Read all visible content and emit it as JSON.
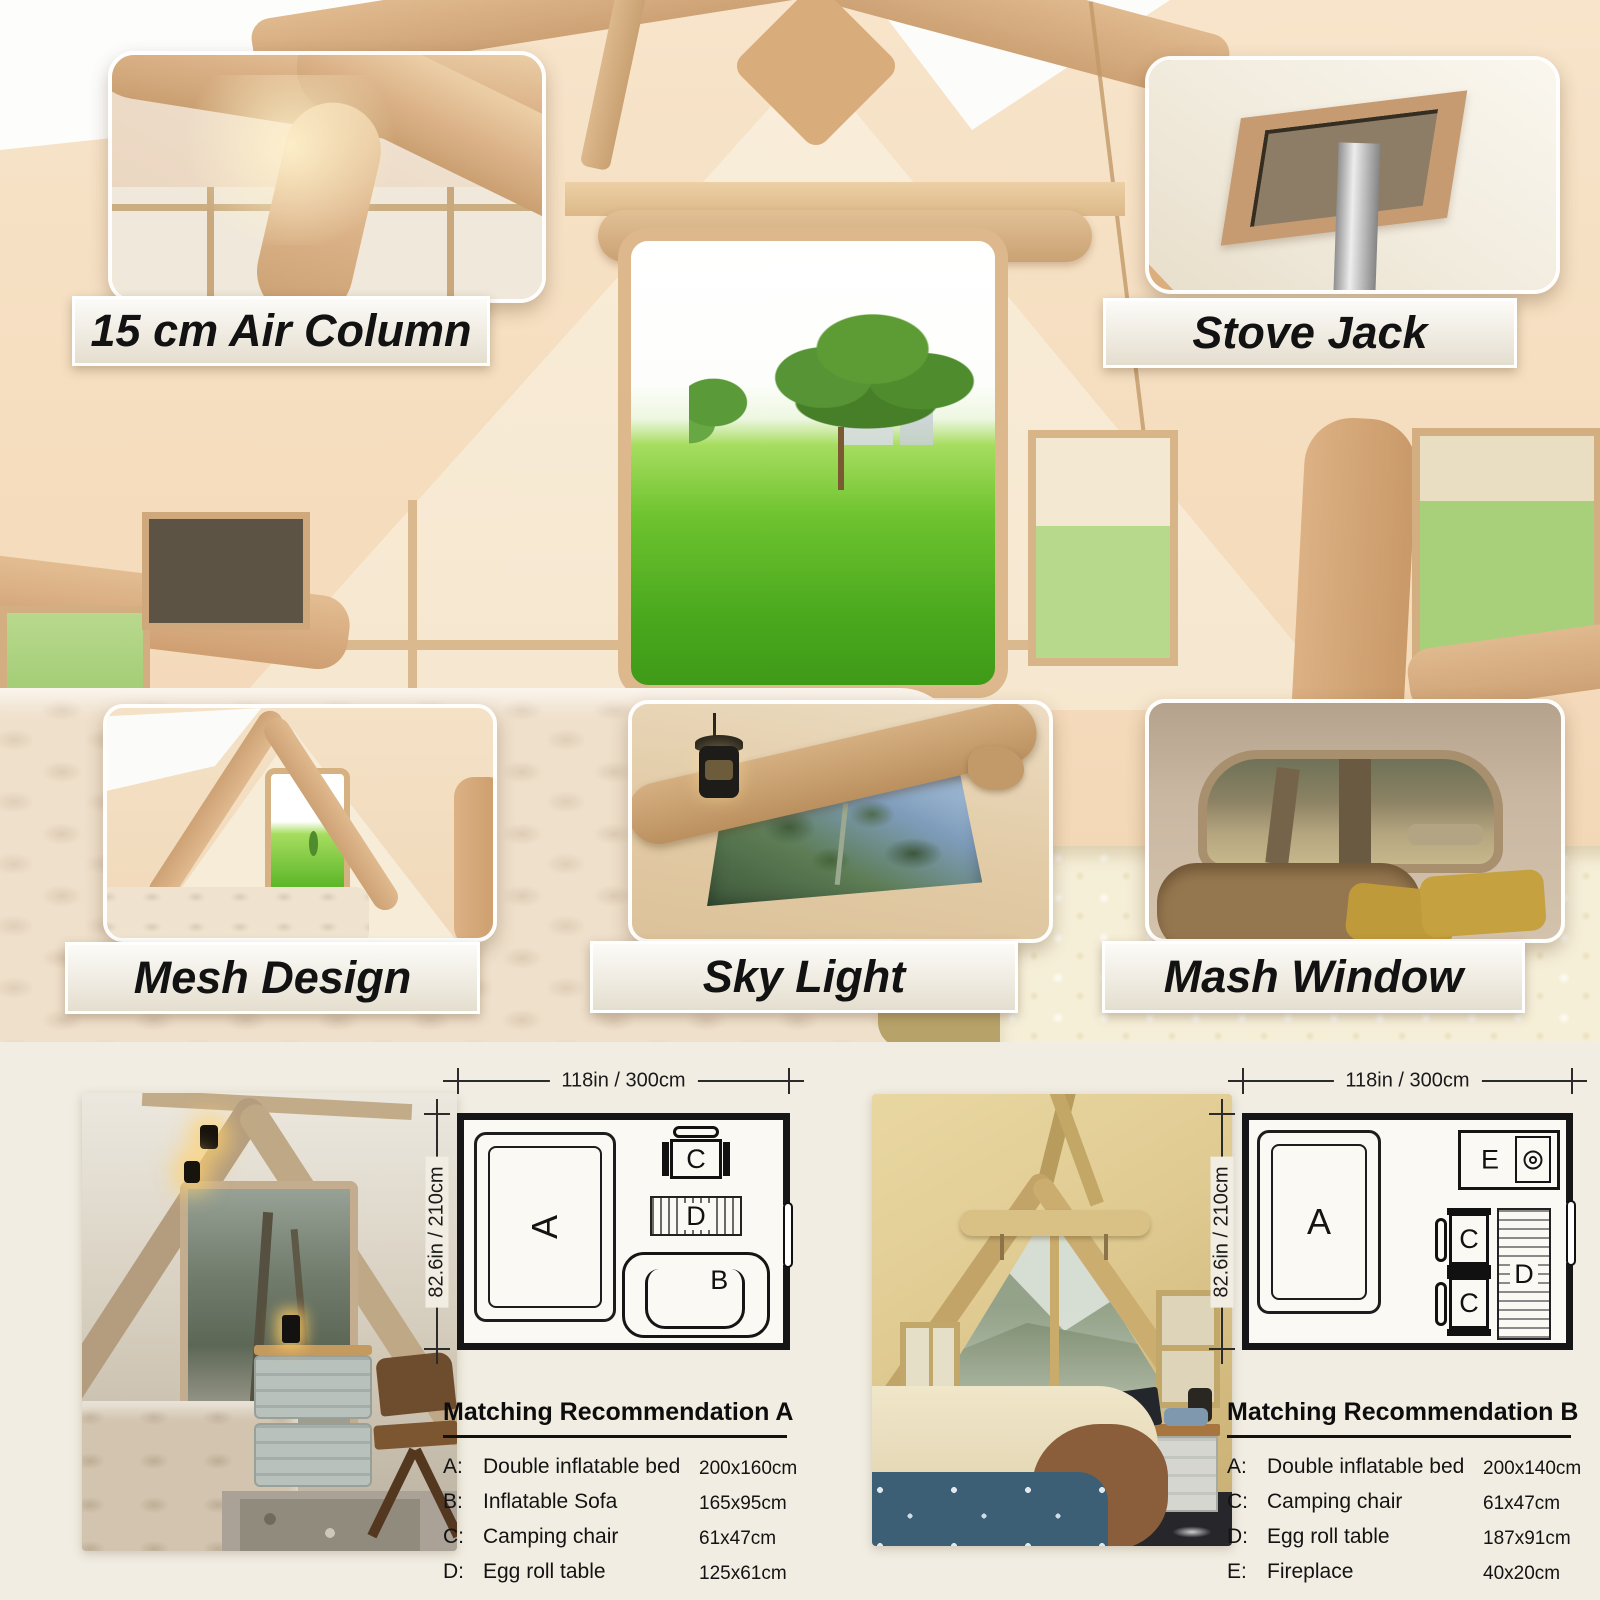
{
  "features": [
    {
      "id": "air-column",
      "label": "15 cm Air Column"
    },
    {
      "id": "stove-jack",
      "label": "Stove Jack"
    },
    {
      "id": "mesh-design",
      "label": "Mesh Design"
    },
    {
      "id": "sky-light",
      "label": "Sky Light"
    },
    {
      "id": "mash-window",
      "label": "Mash Window"
    }
  ],
  "letters": {
    "A": "A",
    "B": "B",
    "C": "C",
    "D": "D",
    "E": "E"
  },
  "plans": [
    {
      "id": "A",
      "width_label": "118in / 300cm",
      "height_label": "82.6in / 210cm"
    },
    {
      "id": "B",
      "width_label": "118in / 300cm",
      "height_label": "82.6in / 210cm"
    }
  ],
  "recommendations": [
    {
      "title": "Matching Recommendation A",
      "items": [
        {
          "key": "A:",
          "name": "Double inflatable bed",
          "size": "200x160cm"
        },
        {
          "key": "B:",
          "name": "Inflatable Sofa",
          "size": "165x95cm"
        },
        {
          "key": "C:",
          "name": "Camping chair",
          "size": "61x47cm"
        },
        {
          "key": "D:",
          "name": "Egg roll table",
          "size": "125x61cm"
        }
      ]
    },
    {
      "title": "Matching Recommendation B",
      "items": [
        {
          "key": "A:",
          "name": "Double inflatable bed",
          "size": "200x140cm"
        },
        {
          "key": "C:",
          "name": "Camping chair",
          "size": "61x47cm"
        },
        {
          "key": "D:",
          "name": "Egg roll table",
          "size": "187x91cm"
        },
        {
          "key": "E:",
          "name": "Fireplace",
          "size": "40x20cm"
        }
      ]
    }
  ],
  "colors": {
    "accent_tan": "#d3a878",
    "section_bg": "#f1ede2",
    "plan_line": "#161616",
    "grass": "#6ec32f",
    "label_text": "#121212"
  }
}
